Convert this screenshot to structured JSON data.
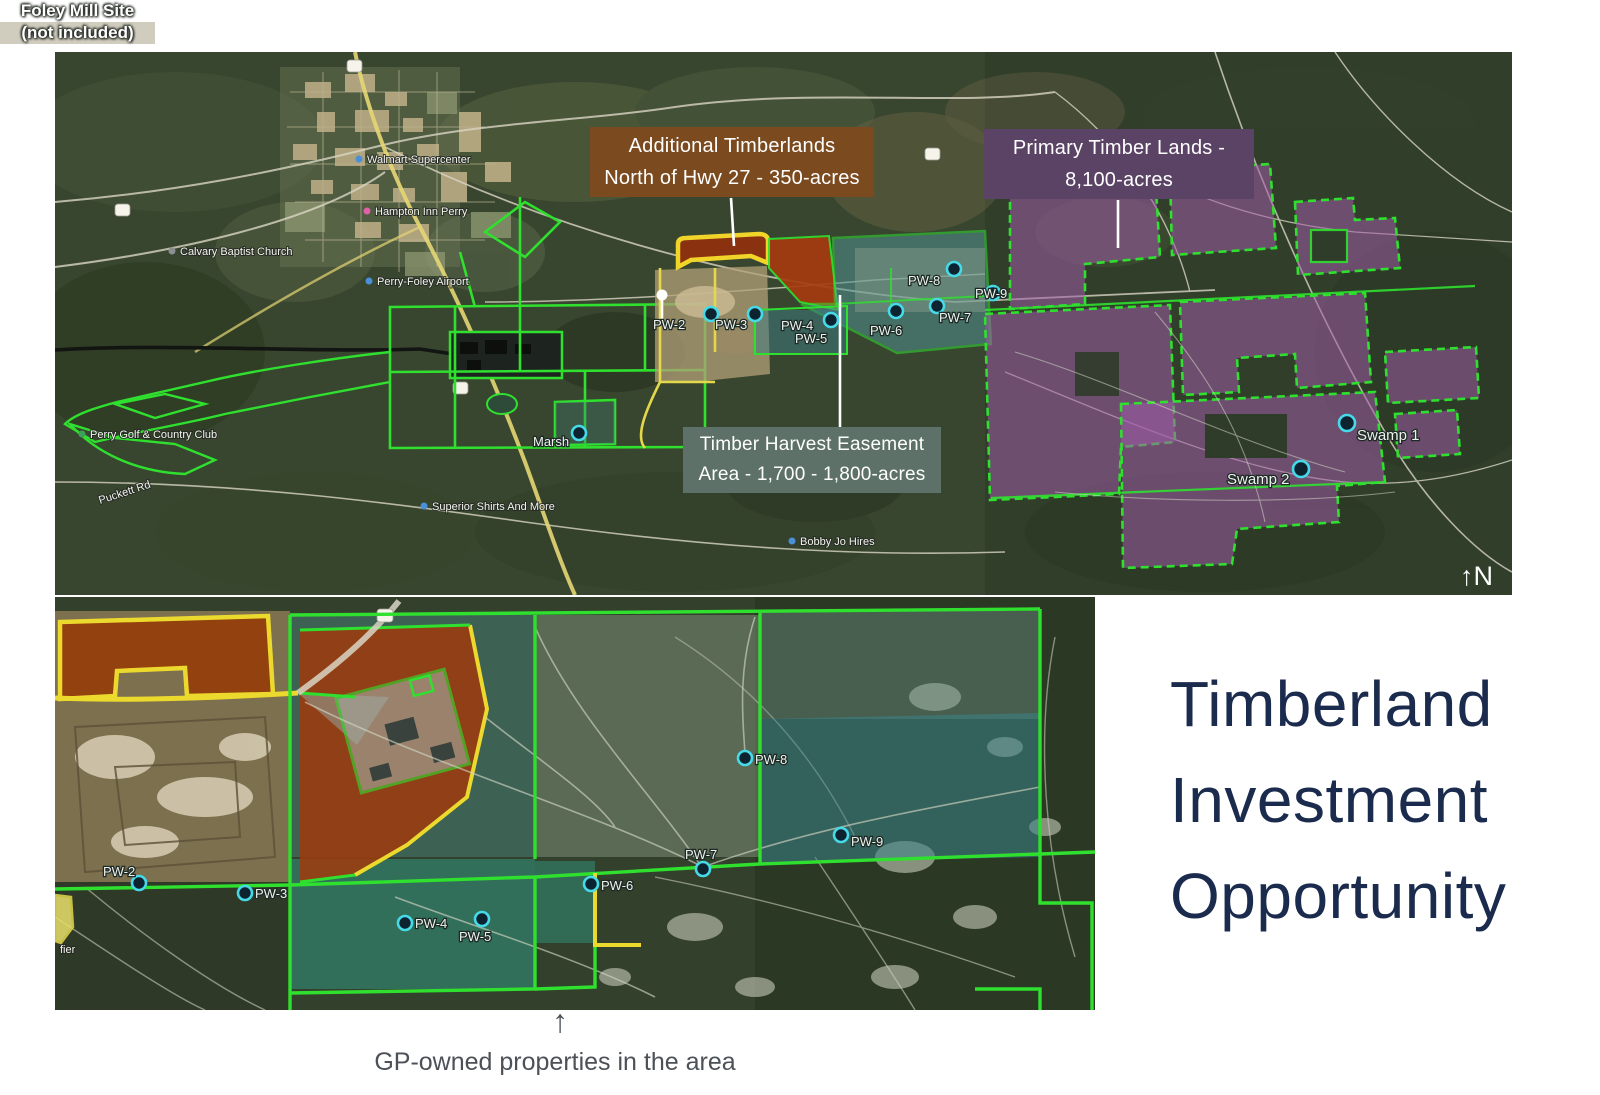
{
  "title": {
    "line1": "Timberland",
    "line2": "Investment",
    "line3": "Opportunity"
  },
  "caption": {
    "arrow": "↑",
    "text": "GP-owned properties in the area"
  },
  "compass": "↑N",
  "colors": {
    "title_text": "#1b2b4d",
    "caption_text": "#4b5157",
    "label_additional_bg": "#7b4a1f",
    "label_primary_bg": "#5a4364",
    "label_easement_bg": "#5d7168",
    "parcel_border_green": "#2fe02f",
    "parcel_border_yellow": "#ecd92d",
    "primary_parcel_fill": "#a05ba8",
    "easement_fill": "#4f9191",
    "harvest_block_fill": "#9a3c10",
    "marker_ring": "#46d9e8"
  },
  "top_map": {
    "callouts": {
      "additional": {
        "line1": "Additional Timberlands",
        "line2": "North of Hwy 27 - 350-acres"
      },
      "primary": {
        "line1": "Primary Timber Lands -",
        "line2": "8,100-acres"
      },
      "easement": {
        "line1": "Timber Harvest Easement",
        "line2": "Area - 1,700 - 1,800-acres"
      },
      "foley": {
        "line1": "Foley Mill Site",
        "line2": "(not included)"
      }
    },
    "markers": [
      {
        "label": "PW-2"
      },
      {
        "label": "PW-3"
      },
      {
        "label": "PW-4"
      },
      {
        "label": "PW-5"
      },
      {
        "label": "PW-6"
      },
      {
        "label": "PW-7"
      },
      {
        "label": "PW-8"
      },
      {
        "label": "PW-9"
      },
      {
        "label": "Marsh"
      },
      {
        "label": "Swamp 1"
      },
      {
        "label": "Swamp 2"
      }
    ],
    "pois": [
      {
        "label": "Walmart Supercenter"
      },
      {
        "label": "Hampton Inn Perry"
      },
      {
        "label": "Calvary Baptist Church"
      },
      {
        "label": "Perry-Foley Airport"
      },
      {
        "label": "Perry Golf & Country Club"
      },
      {
        "label": "Puckett Rd"
      },
      {
        "label": "Superior Shirts And More"
      },
      {
        "label": "Bobby Jo Hires"
      }
    ]
  },
  "bottom_map": {
    "markers": [
      {
        "label": "PW-2"
      },
      {
        "label": "PW-3"
      },
      {
        "label": "PW-4"
      },
      {
        "label": "PW-5"
      },
      {
        "label": "PW-6"
      },
      {
        "label": "PW-7"
      },
      {
        "label": "PW-8"
      },
      {
        "label": "PW-9"
      }
    ],
    "edge_label": "fier"
  }
}
